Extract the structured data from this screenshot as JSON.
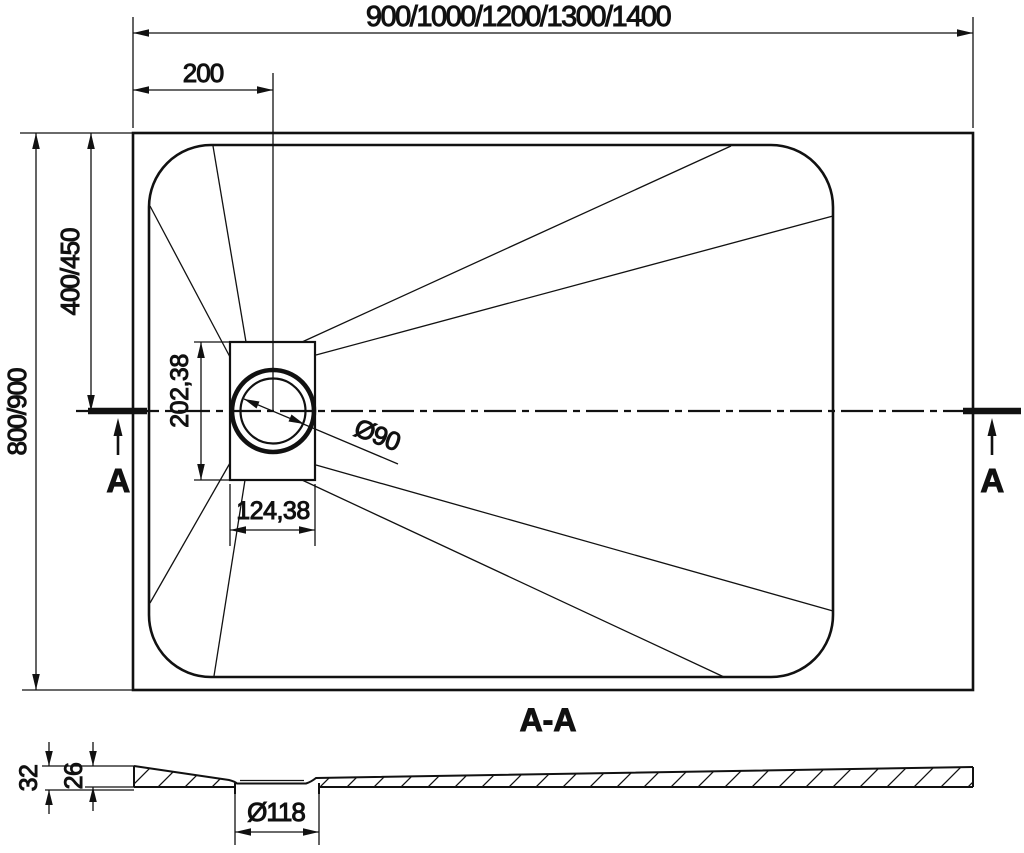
{
  "drawing": {
    "type": "technical-drawing-shower-tray",
    "colors": {
      "line": "#111111",
      "background": "#ffffff"
    },
    "top_view": {
      "dim_length_options": "900/1000/1200/1300/1400",
      "dim_drain_offset_x": "200",
      "dim_width_options": "800/900",
      "dim_half_width": "400/450",
      "dim_drain_center_from_top": "202,38",
      "dim_drain_center_from_left": "124,38",
      "dim_drain_diameter": "Ø90",
      "section_marker_left": "A",
      "section_marker_right": "A"
    },
    "section_view": {
      "title": "A-A",
      "dim_total_height": "32",
      "dim_edge_height": "26",
      "dim_recess_diameter": "Ø118"
    }
  }
}
